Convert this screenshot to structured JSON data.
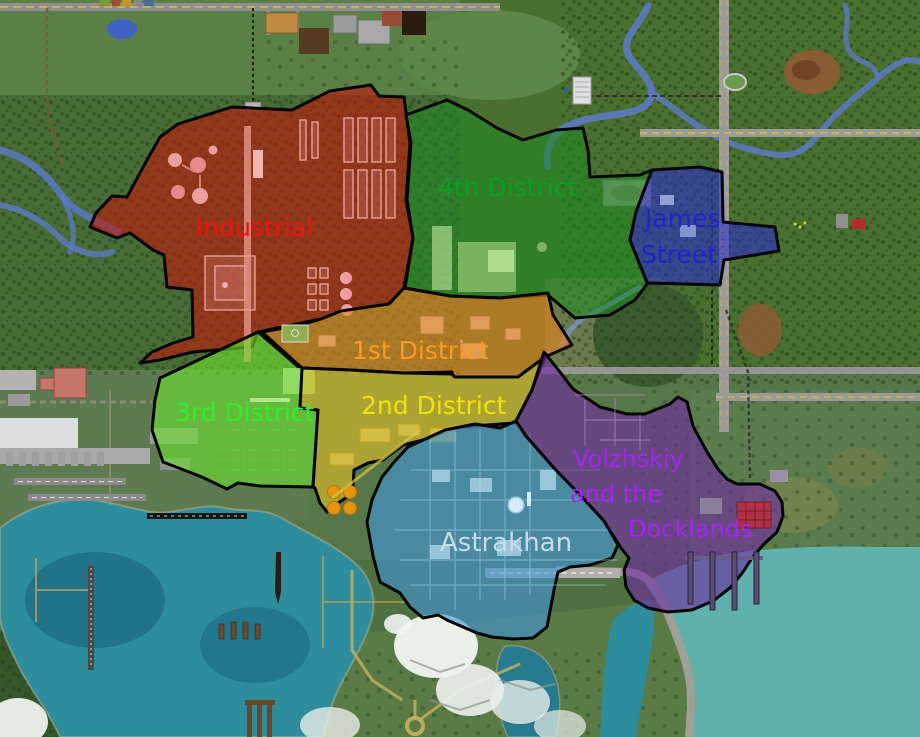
{
  "map": {
    "districts": {
      "industrial": {
        "name": "Industrial",
        "label_color": "#ee1212",
        "fill_color": "rgba(193,22,10,0.60)"
      },
      "fourth_district": {
        "name": "4th District",
        "label_color": "#0b9e26",
        "fill_color": "rgba(28,138,32,0.55)"
      },
      "james_street": {
        "name": "James Street",
        "label_line1": "James",
        "label_line2": "Street",
        "label_color": "#2222cc",
        "fill_color": "rgba(44,46,196,0.60)"
      },
      "first_district": {
        "name": "1st District",
        "label_color": "#ff9a1e",
        "fill_color": "rgba(230,130,30,0.62)"
      },
      "third_district": {
        "name": "3rd District",
        "label_color": "#2dee2d",
        "fill_color": "rgba(110,224,48,0.62)"
      },
      "second_district": {
        "name": "2nd District",
        "label_color": "#f2e10a",
        "fill_color": "rgba(222,192,40,0.62)"
      },
      "astrakhan": {
        "name": "Astrakhan",
        "label_color": "#c8dcea",
        "fill_color": "rgba(64,150,215,0.62)"
      },
      "volzhskiy_docklands": {
        "name": "Volzhskiy and the Docklands",
        "label_line1": "Volzhskiy",
        "label_line2": "and the",
        "label_line3": "Docklands",
        "label_color": "#a424f2",
        "fill_color": "rgba(112,44,162,0.62)"
      }
    }
  }
}
